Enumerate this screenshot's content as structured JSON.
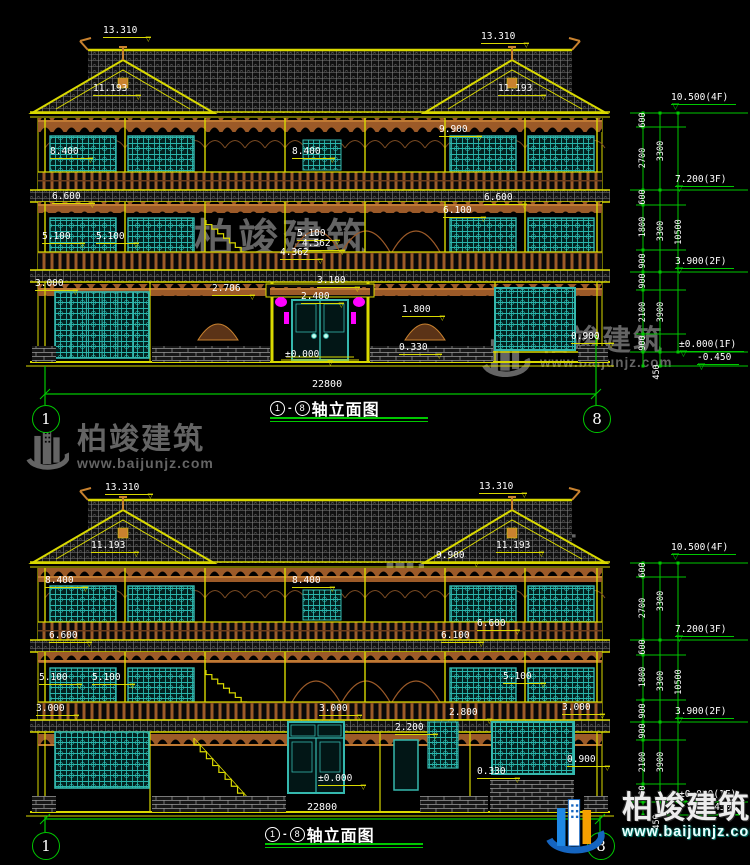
{
  "meta": {
    "brand": "柏竣建筑",
    "url": "www.baijunjz.com",
    "tri": "▽",
    "colors": {
      "background": "#000000",
      "line_yellow": "#d9d900",
      "dim_green": "#00c800",
      "text_white": "#ffffff",
      "window_teal": "#35b8ae",
      "wood_brown": "#9c5a28",
      "lantern_magenta": "#ff00ff",
      "watermark_gray": "#646464",
      "logo_blue": "#1565c0",
      "logo_orange": "#f59f00"
    }
  },
  "drawings": [
    {
      "name": "elevation-1",
      "title": {
        "start": "1",
        "dash": "-",
        "end": "8",
        "label": "轴立面图"
      },
      "overall_dim": "22800",
      "odim": {
        "x": 312,
        "y": 379
      },
      "axes": [
        {
          "n": "1",
          "x": 45,
          "y": 418
        },
        {
          "n": "8",
          "x": 596,
          "y": 418
        }
      ],
      "labels": [
        {
          "t": "13.310",
          "x": 103,
          "y": 26
        },
        {
          "t": "11.193",
          "x": 93,
          "y": 84
        },
        {
          "t": "8.400",
          "x": 50,
          "y": 147
        },
        {
          "t": "6.600",
          "x": 52,
          "y": 192
        },
        {
          "t": "5.100",
          "x": 42,
          "y": 232
        },
        {
          "t": "5.100",
          "x": 96,
          "y": 232
        },
        {
          "t": "3.000",
          "x": 35,
          "y": 279
        },
        {
          "t": "8.400",
          "x": 292,
          "y": 147
        },
        {
          "t": "5.100",
          "x": 297,
          "y": 229
        },
        {
          "t": "4.562",
          "x": 302,
          "y": 239
        },
        {
          "t": "4.362",
          "x": 280,
          "y": 248
        },
        {
          "t": "3.100",
          "x": 317,
          "y": 276
        },
        {
          "t": "2.400",
          "x": 301,
          "y": 292
        },
        {
          "t": "2.706",
          "x": 212,
          "y": 284
        },
        {
          "t": "1.800",
          "x": 402,
          "y": 305
        },
        {
          "t": "0.330",
          "x": 399,
          "y": 343
        },
        {
          "t": "±0.000",
          "x": 285,
          "y": 350
        },
        {
          "t": "13.310",
          "x": 481,
          "y": 32
        },
        {
          "t": "11.193",
          "x": 498,
          "y": 84
        },
        {
          "t": "9.900",
          "x": 439,
          "y": 125
        },
        {
          "t": "6.600",
          "x": 484,
          "y": 193
        },
        {
          "t": "6.100",
          "x": 443,
          "y": 206
        },
        {
          "t": "0.900",
          "x": 571,
          "y": 332
        }
      ],
      "levels": [
        {
          "t": "10.500(4F)",
          "x": 671,
          "y": 93
        },
        {
          "t": "7.200(3F)",
          "x": 675,
          "y": 175
        },
        {
          "t": "3.900(2F)",
          "x": 675,
          "y": 257
        },
        {
          "t": "±0.000(1F)",
          "x": 679,
          "y": 340
        },
        {
          "t": "-0.450",
          "x": 697,
          "y": 353
        }
      ],
      "vdims": [
        {
          "t": "600",
          "x": 643,
          "y": 120
        },
        {
          "t": "2700",
          "x": 643,
          "y": 158
        },
        {
          "t": "600",
          "x": 643,
          "y": 197
        },
        {
          "t": "1800",
          "x": 643,
          "y": 227
        },
        {
          "t": "900",
          "x": 643,
          "y": 261
        },
        {
          "t": "900",
          "x": 643,
          "y": 281
        },
        {
          "t": "2100",
          "x": 643,
          "y": 312
        },
        {
          "t": "900",
          "x": 643,
          "y": 343
        },
        {
          "t": "3300",
          "x": 661,
          "y": 151
        },
        {
          "t": "3300",
          "x": 661,
          "y": 231
        },
        {
          "t": "3900",
          "x": 661,
          "y": 312
        },
        {
          "t": "10500",
          "x": 679,
          "y": 232
        },
        {
          "t": "450",
          "x": 657,
          "y": 372
        }
      ]
    },
    {
      "name": "elevation-2",
      "title": {
        "start": "1",
        "dash": "-",
        "end": "8",
        "label": "轴立面图"
      },
      "overall_dim": "22800",
      "odim": {
        "x": 307,
        "y": 802
      },
      "axes": [
        {
          "n": "1",
          "x": 45,
          "y": 845
        },
        {
          "n": "8",
          "x": 600,
          "y": 845
        }
      ],
      "labels": [
        {
          "t": "13.310",
          "x": 105,
          "y": 483
        },
        {
          "t": "11.193",
          "x": 91,
          "y": 541
        },
        {
          "t": "8.400",
          "x": 45,
          "y": 576
        },
        {
          "t": "8.400",
          "x": 292,
          "y": 576
        },
        {
          "t": "9.900",
          "x": 436,
          "y": 551
        },
        {
          "t": "13.310",
          "x": 479,
          "y": 482
        },
        {
          "t": "11.193",
          "x": 496,
          "y": 541
        },
        {
          "t": "6.600",
          "x": 49,
          "y": 631
        },
        {
          "t": "6.600",
          "x": 477,
          "y": 619
        },
        {
          "t": "6.100",
          "x": 441,
          "y": 631
        },
        {
          "t": "5.100",
          "x": 39,
          "y": 673
        },
        {
          "t": "5.100",
          "x": 92,
          "y": 673
        },
        {
          "t": "5.100",
          "x": 503,
          "y": 672
        },
        {
          "t": "3.000",
          "x": 36,
          "y": 704
        },
        {
          "t": "3.000",
          "x": 319,
          "y": 704
        },
        {
          "t": "3.000",
          "x": 562,
          "y": 703
        },
        {
          "t": "2.800",
          "x": 449,
          "y": 708
        },
        {
          "t": "2.200",
          "x": 395,
          "y": 723
        },
        {
          "t": "±0.000",
          "x": 318,
          "y": 774
        },
        {
          "t": "0.900",
          "x": 567,
          "y": 755
        },
        {
          "t": "0.330",
          "x": 477,
          "y": 767
        }
      ],
      "levels": [
        {
          "t": "10.500(4F)",
          "x": 671,
          "y": 543
        },
        {
          "t": "7.200(3F)",
          "x": 675,
          "y": 625
        },
        {
          "t": "3.900(2F)",
          "x": 675,
          "y": 707
        },
        {
          "t": "±0.000(1F)",
          "x": 679,
          "y": 790
        },
        {
          "t": "-0.450",
          "x": 697,
          "y": 803
        }
      ],
      "vdims": [
        {
          "t": "600",
          "x": 643,
          "y": 570
        },
        {
          "t": "2700",
          "x": 643,
          "y": 608
        },
        {
          "t": "600",
          "x": 643,
          "y": 647
        },
        {
          "t": "1800",
          "x": 643,
          "y": 677
        },
        {
          "t": "900",
          "x": 643,
          "y": 711
        },
        {
          "t": "900",
          "x": 643,
          "y": 731
        },
        {
          "t": "2100",
          "x": 643,
          "y": 762
        },
        {
          "t": "900",
          "x": 643,
          "y": 793
        },
        {
          "t": "3300",
          "x": 661,
          "y": 601
        },
        {
          "t": "3300",
          "x": 661,
          "y": 681
        },
        {
          "t": "3900",
          "x": 661,
          "y": 762
        },
        {
          "t": "10500",
          "x": 679,
          "y": 682
        },
        {
          "t": "450",
          "x": 657,
          "y": 822
        }
      ]
    }
  ]
}
